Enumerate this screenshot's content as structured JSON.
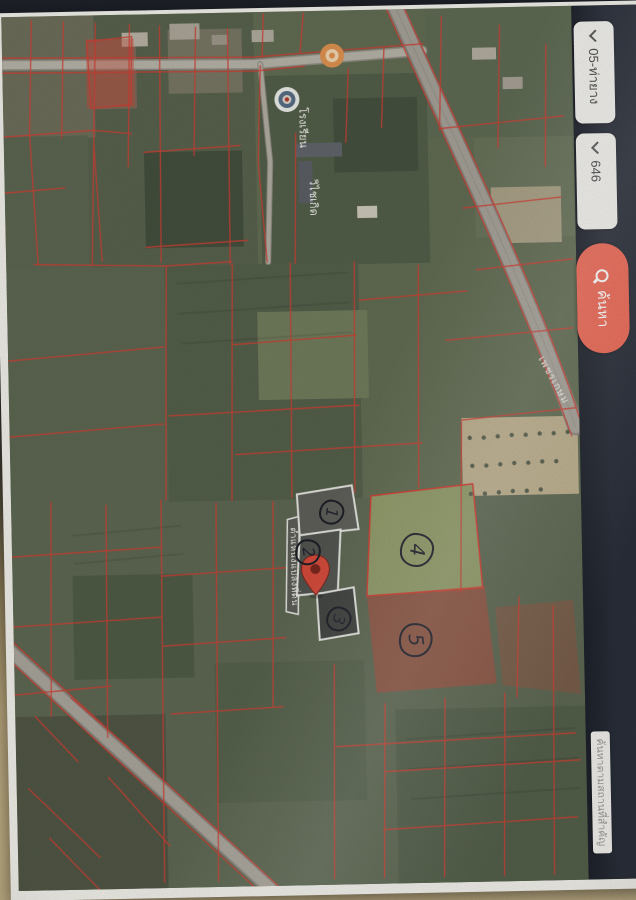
{
  "sidebar": {
    "select_zone": {
      "value": "05-ท่ายาง"
    },
    "select_sheet": {
      "value": "646"
    },
    "search": {
      "label": "ค้นหา"
    },
    "side_tab": {
      "label": "ค้นหาตามสถานที่สำคัญ"
    }
  },
  "map": {
    "school_label": {
      "line1": "โรงเรียน",
      "line2": "วิไชเกิด"
    },
    "road_label": "เพชรเกษม",
    "pin_label": "ตำแหน่งแปลงที่ดิน",
    "numbers": [
      "1",
      "2",
      "3",
      "4",
      "5"
    ]
  },
  "colors": {
    "accent_button": "#ee6a57",
    "sidebar_bg": "#2b303b",
    "parcel_line": "#e03527",
    "pin": "#e8412e"
  }
}
